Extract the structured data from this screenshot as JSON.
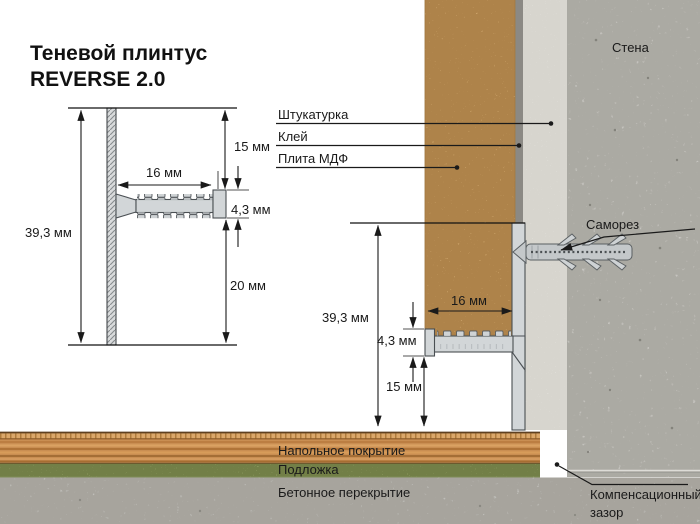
{
  "title": {
    "line1": "Теневой плинтус",
    "line2": "REVERSE 2.0"
  },
  "profile_view": {
    "dim_total_height": "39,3 мм",
    "dim_top_offset": "15 мм",
    "dim_flange_length": "16 мм",
    "dim_flange_thickness": "4,3 мм",
    "dim_bottom_offset": "20 мм"
  },
  "install_view": {
    "dim_total_height": "39,3 мм",
    "dim_flange_length": "16 мм",
    "dim_flange_thickness": "4,3 мм",
    "dim_floor_gap": "15 мм"
  },
  "callouts": {
    "plaster": "Штукатурка",
    "glue": "Клей",
    "mdf_board": "Плита МДФ",
    "wall": "Стена",
    "screw": "Саморез",
    "floor_covering": "Напольное покрытие",
    "underlay": "Подложка",
    "concrete_slab": "Бетонное перекрытие",
    "expansion_gap_line1": "Компенсационный",
    "expansion_gap_line2": "зазор"
  },
  "colors": {
    "mdf": "#d5ad74",
    "plaster": "#edece8",
    "wall": "#c7c6c1",
    "glue": "#8b8984",
    "aluminum": "#d2d6d8",
    "wood": "#c98e52",
    "underlay": "#a3b074",
    "concrete": "#bfbeb9",
    "line": "#1a1a1a"
  }
}
